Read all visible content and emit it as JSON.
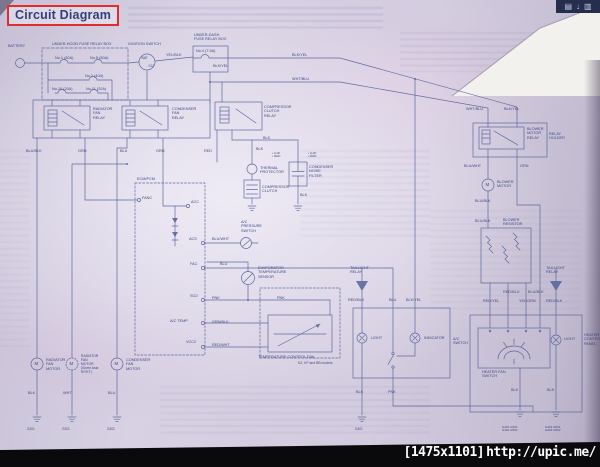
{
  "header": {
    "title": "Circuit Diagram"
  },
  "page_toolbar": {
    "icons": [
      "panel-grid-icon",
      "download-arrow-icon",
      "panel-grid-icon"
    ],
    "glyphs": [
      "▤",
      "↓",
      "▥"
    ]
  },
  "watermark": {
    "resolution": "[1475x1101]",
    "url": "http://upic.me/"
  },
  "diagram": {
    "labels": [
      {
        "name": "battery-label",
        "text": "BATTERY",
        "x": 8,
        "y": 44
      },
      {
        "name": "underhood-box-label",
        "text": "UNDER-HOOD FUSE RELAY BOX",
        "x": 52,
        "y": 42
      },
      {
        "name": "fuse-no1-label",
        "text": "No.1 (80A)",
        "x": 55,
        "y": 56
      },
      {
        "name": "fuse-no5-label",
        "text": "No.5 (80A)",
        "x": 90,
        "y": 56
      },
      {
        "name": "fuse-no2-label",
        "text": "No.2 (40A)",
        "x": 85,
        "y": 73.5
      },
      {
        "name": "fuse-no10-label",
        "text": "No.10 (20A)",
        "x": 52,
        "y": 86.5
      },
      {
        "name": "fuse-no11-label",
        "text": "No.11 (20A)",
        "x": 86,
        "y": 86.5
      },
      {
        "name": "ignition-switch-label",
        "text": "IGNITION SWITCH",
        "x": 128,
        "y": 42
      },
      {
        "name": "ignition-bat-terminal",
        "text": "BAT",
        "x": 141.5,
        "y": 57,
        "s": 3.4
      },
      {
        "name": "ignition-ig2-terminal",
        "text": "IG2",
        "x": 148.5,
        "y": 64.5,
        "s": 3.4
      },
      {
        "name": "wire-yel-blk-1",
        "text": "YEL/BLK",
        "x": 166,
        "y": 52.5
      },
      {
        "name": "underdash-box-label",
        "text": "UNDER-DASH\nFUSE RELAY BOX",
        "x": 194,
        "y": 33
      },
      {
        "name": "fuse-no4-label",
        "text": "No.4 (7.5A)",
        "x": 196,
        "y": 49
      },
      {
        "name": "wire-blk-yel-1",
        "text": "BLK/YEL",
        "x": 292,
        "y": 52.5
      },
      {
        "name": "wire-wht-blu-1",
        "text": "WHT/BLU",
        "x": 292,
        "y": 76.5
      },
      {
        "name": "wire-blk-yel-2",
        "text": "BLK/YEL",
        "x": 213,
        "y": 64
      },
      {
        "name": "radiator-fan-relay-label",
        "text": "RADIATOR\nFAN\nRELAY",
        "x": 93,
        "y": 107
      },
      {
        "name": "condenser-fan-relay-label",
        "text": "CONDENSER\nFAN\nRELAY",
        "x": 172,
        "y": 107
      },
      {
        "name": "compressor-clutch-relay-label",
        "text": "COMPRESSOR\nCLUTCH\nRELAY",
        "x": 264,
        "y": 105
      },
      {
        "name": "wire-blu-blk-1",
        "text": "BLU/BLK",
        "x": 26,
        "y": 148.5
      },
      {
        "name": "wire-grn-1",
        "text": "GRN",
        "x": 78,
        "y": 148.5
      },
      {
        "name": "wire-blu-1",
        "text": "BLU",
        "x": 120,
        "y": 148.5
      },
      {
        "name": "wire-grn-2",
        "text": "GRN",
        "x": 156,
        "y": 148.5
      },
      {
        "name": "wire-red-1",
        "text": "RED",
        "x": 204,
        "y": 148.5
      },
      {
        "name": "wire-blk-1",
        "text": "BLK",
        "x": 263,
        "y": 136
      },
      {
        "name": "wire-blk-2",
        "text": "BLK",
        "x": 256,
        "y": 146.5
      },
      {
        "name": "thermal-protector-label",
        "text": "THERMAL\nPROTECTOR",
        "x": 260,
        "y": 166
      },
      {
        "name": "compressor-clutch-label",
        "text": "COMPRESSOR\nCLUTCH",
        "x": 262,
        "y": 185
      },
      {
        "name": "condenser-noise-filter-label",
        "text": "CONDENSER\nNOISE\nFILTER",
        "x": 309,
        "y": 165
      },
      {
        "name": "filter-lhd-rhd-left",
        "text": "• LHD\n• RHD",
        "x": 272,
        "y": 152,
        "s": 3
      },
      {
        "name": "filter-lhd-rhd-right",
        "text": "• LHD\n• RHD",
        "x": 308,
        "y": 152,
        "s": 3
      },
      {
        "name": "wire-blk-3",
        "text": "BLK",
        "x": 300,
        "y": 193
      },
      {
        "name": "ecm-pcm-label",
        "text": "ECM/PCM",
        "x": 137,
        "y": 177
      },
      {
        "name": "ecm-fanc-terminal",
        "text": "FANC",
        "x": 142,
        "y": 195.5
      },
      {
        "name": "ecm-acc-terminal",
        "text": "ACC",
        "x": 191,
        "y": 199.5
      },
      {
        "name": "ecm-acs-terminal",
        "text": "ACS",
        "x": 189,
        "y": 237
      },
      {
        "name": "wire-blu-wht-1",
        "text": "BLU/WHT",
        "x": 212,
        "y": 237
      },
      {
        "name": "ac-pressure-switch-label",
        "text": "A/C\nPRESSURE\nSWITCH",
        "x": 241,
        "y": 220
      },
      {
        "name": "ecm-fac-terminal",
        "text": "FAC",
        "x": 190,
        "y": 262
      },
      {
        "name": "wire-blu-2",
        "text": "BLU",
        "x": 220,
        "y": 262
      },
      {
        "name": "ecm-sg2-terminal",
        "text": "SG2",
        "x": 190,
        "y": 294
      },
      {
        "name": "wire-pnk-1",
        "text": "PNK",
        "x": 212,
        "y": 295.5
      },
      {
        "name": "wire-pnk-2",
        "text": "PNK",
        "x": 277,
        "y": 295.5
      },
      {
        "name": "ecm-actemp-terminal",
        "text": "A/C TEMP",
        "x": 170,
        "y": 318.5
      },
      {
        "name": "wire-grn-blk-1",
        "text": "GRN/BLK",
        "x": 212,
        "y": 319.5
      },
      {
        "name": "ecm-vcc2-terminal",
        "text": "VCC2",
        "x": 186,
        "y": 340
      },
      {
        "name": "wire-red-wht-1",
        "text": "RED/WHT",
        "x": 212,
        "y": 343
      },
      {
        "name": "evaporator-sensor-label",
        "text": "EVAPORATOR\nTEMPERATURE\nSENSOR",
        "x": 258,
        "y": 266
      },
      {
        "name": "temp-control-dial-label",
        "text": "TEMPERATURE CONTROL DIAL",
        "x": 258,
        "y": 355
      },
      {
        "name": "temp-dial-models-note",
        "text": "KZ, KF and BB models",
        "x": 298,
        "y": 361.5,
        "s": 3.4
      },
      {
        "name": "taillight-relay-label-1",
        "text": "TAILLIGHT\nRELAY",
        "x": 350,
        "y": 266
      },
      {
        "name": "wire-red-blk-1",
        "text": "RED/BLK",
        "x": 348,
        "y": 298
      },
      {
        "name": "wire-blu-3",
        "text": "BLU",
        "x": 389,
        "y": 298
      },
      {
        "name": "wire-blk-yel-3",
        "text": "BLK/YEL",
        "x": 406,
        "y": 298
      },
      {
        "name": "ac-switch-light-label",
        "text": "LIGHT",
        "x": 371,
        "y": 336
      },
      {
        "name": "ac-switch-indicator-label",
        "text": "INDICATOR",
        "x": 424,
        "y": 336
      },
      {
        "name": "ac-switch-label",
        "text": "A/C\nSWITCH",
        "x": 453,
        "y": 337
      },
      {
        "name": "wire-blk-4",
        "text": "BLK",
        "x": 356,
        "y": 390
      },
      {
        "name": "wire-pnk-3",
        "text": "PNK",
        "x": 388,
        "y": 390
      },
      {
        "name": "ground-g401-label",
        "text": "G401",
        "x": 355,
        "y": 428,
        "s": 3.2
      },
      {
        "name": "wire-wht-blu-2",
        "text": "WHT/BLU",
        "x": 466,
        "y": 107
      },
      {
        "name": "wire-blk-yel-4",
        "text": "BLK/YEL",
        "x": 504,
        "y": 107
      },
      {
        "name": "blower-motor-relay-label",
        "text": "BLOWER\nMOTOR\nRELAY",
        "x": 527,
        "y": 127
      },
      {
        "name": "relay-holder-label",
        "text": "RELAY\nHOLDER",
        "x": 549,
        "y": 132
      },
      {
        "name": "wire-blu-wht-2",
        "text": "BLU/WHT",
        "x": 464,
        "y": 163.5
      },
      {
        "name": "wire-grn-3",
        "text": "GRN",
        "x": 520,
        "y": 163.5
      },
      {
        "name": "blower-motor-label",
        "text": "BLOWER\nMOTOR",
        "x": 497,
        "y": 180
      },
      {
        "name": "wire-blu-blk-2",
        "text": "BLU/BLK",
        "x": 475,
        "y": 198.5
      },
      {
        "name": "wire-blu-blk-3",
        "text": "BLU/BLK",
        "x": 475,
        "y": 219
      },
      {
        "name": "blower-resistor-label",
        "text": "BLOWER\nRESISTOR",
        "x": 503,
        "y": 218
      },
      {
        "name": "wire-red-blu-1",
        "text": "RED/BLU",
        "x": 503,
        "y": 289.5
      },
      {
        "name": "wire-blu-blk-4",
        "text": "BLU/BLK",
        "x": 528,
        "y": 289.5
      },
      {
        "name": "wire-red-yel-1",
        "text": "RED/YEL",
        "x": 483,
        "y": 298.5
      },
      {
        "name": "wire-yel-grn-1",
        "text": "YEL/GRN",
        "x": 519,
        "y": 298.5
      },
      {
        "name": "wire-red-blk-2",
        "text": "RED/BLK",
        "x": 546,
        "y": 298.5
      },
      {
        "name": "taillight-relay-label-2",
        "text": "TAILLIGHT\nRELAY",
        "x": 546,
        "y": 266
      },
      {
        "name": "heater-fan-switch-label",
        "text": "HEATER FAN\nSWITCH",
        "x": 482,
        "y": 370
      },
      {
        "name": "heater-light-label",
        "text": "LIGHT",
        "x": 564,
        "y": 337
      },
      {
        "name": "heater-control-panel-label",
        "text": "HEATER\nCONTROL\nPANEL",
        "x": 584,
        "y": 333
      },
      {
        "name": "wire-blk-5",
        "text": "BLK",
        "x": 511,
        "y": 388
      },
      {
        "name": "wire-blk-6",
        "text": "BLK",
        "x": 547,
        "y": 388
      },
      {
        "name": "ground-labels-left",
        "text": "G401  G501\nG402  G502",
        "x": 502,
        "y": 425.5,
        "s": 3
      },
      {
        "name": "ground-labels-right",
        "text": "G401  G501\nG402  G502",
        "x": 545,
        "y": 425.5,
        "s": 3
      },
      {
        "name": "radiator-fan-motor-label",
        "text": "RADIATOR\nFAN\nMOTOR",
        "x": 46,
        "y": 358
      },
      {
        "name": "radiator-fan-motor-2-label",
        "text": "RADIATOR\nFAN\nMOTOR\n(Some Asia\nKF/KT)",
        "x": 81,
        "y": 355,
        "s": 3.4
      },
      {
        "name": "condenser-fan-motor-label",
        "text": "CONDENSER\nFAN\nMOTOR",
        "x": 126,
        "y": 358
      },
      {
        "name": "wire-blk-7",
        "text": "BLK",
        "x": 28,
        "y": 391
      },
      {
        "name": "wire-wht-1",
        "text": "WHT",
        "x": 63,
        "y": 391
      },
      {
        "name": "wire-blu-4",
        "text": "BLU",
        "x": 108,
        "y": 391
      },
      {
        "name": "ground-g201-label-1",
        "text": "G201",
        "x": 27,
        "y": 428,
        "s": 3.2
      },
      {
        "name": "ground-g201-label-2",
        "text": "G201",
        "x": 62,
        "y": 428,
        "s": 3.2
      },
      {
        "name": "ground-g202-label",
        "text": "G202",
        "x": 107,
        "y": 428,
        "s": 3.2
      },
      {
        "name": "motor-m-1",
        "text": "M",
        "x": 34.5,
        "y": 361,
        "s": 4.4
      },
      {
        "name": "motor-m-2",
        "text": "M",
        "x": 69.5,
        "y": 361,
        "s": 4.4
      },
      {
        "name": "motor-m-3",
        "text": "M",
        "x": 114.5,
        "y": 361,
        "s": 4.4
      },
      {
        "name": "motor-m-blower",
        "text": "M",
        "x": 485.5,
        "y": 182,
        "s": 4.4
      }
    ]
  }
}
